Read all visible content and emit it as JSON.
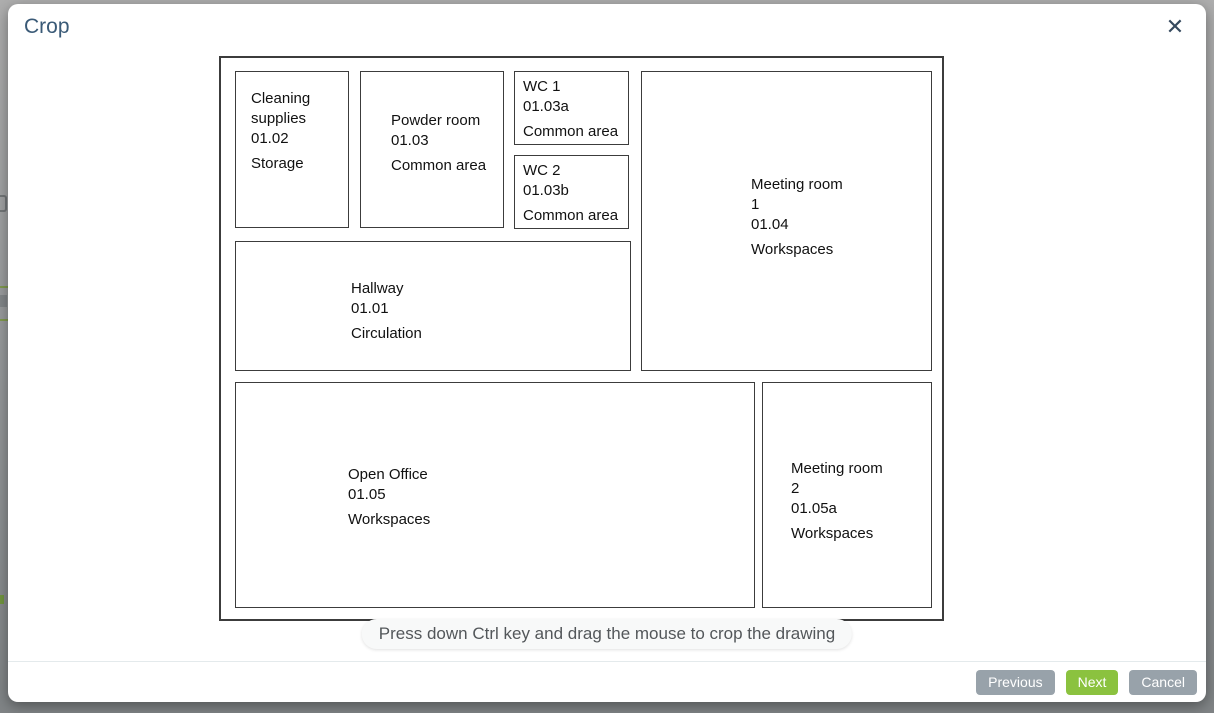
{
  "dialog": {
    "title": "Crop",
    "close_icon": "✕",
    "tooltip": "Press down Ctrl key and drag the mouse to crop the drawing",
    "buttons": {
      "previous": "Previous",
      "next": "Next",
      "cancel": "Cancel"
    }
  },
  "colors": {
    "title_text": "#3a5a77",
    "next_button_green": "#8bc23f",
    "secondary_button_gray": "#98a2aa",
    "plan_line": "#3c3c3c"
  },
  "floor_plan": {
    "rooms": [
      {
        "name": "Cleaning supplies",
        "code": "01.02",
        "category": "Storage"
      },
      {
        "name": "Powder room",
        "code": "01.03",
        "category": "Common area"
      },
      {
        "name": "WC 1",
        "code": "01.03a",
        "category": "Common area"
      },
      {
        "name": "WC 2",
        "code": "01.03b",
        "category": "Common area"
      },
      {
        "name": "Meeting room 1",
        "code": "01.04",
        "category": "Workspaces"
      },
      {
        "name": "Hallway",
        "code": "01.01",
        "category": "Circulation"
      },
      {
        "name": "Open Office",
        "code": "01.05",
        "category": "Workspaces"
      },
      {
        "name": "Meeting room 2",
        "code": "01.05a",
        "category": "Workspaces"
      }
    ]
  }
}
